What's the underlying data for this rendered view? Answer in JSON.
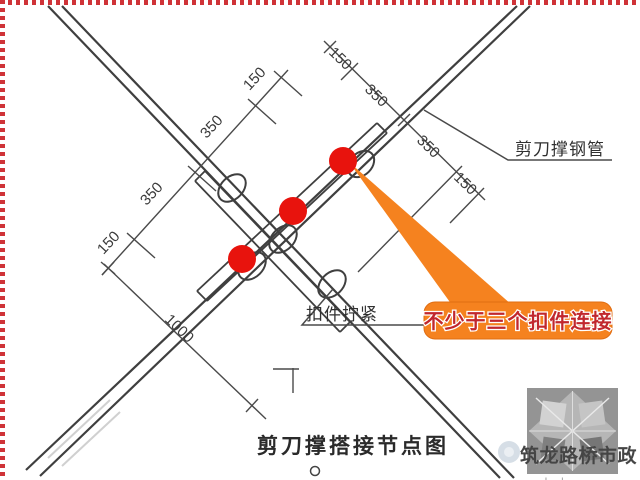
{
  "title_block": {
    "drawing_title": "剪刀撑搭接节点图"
  },
  "labels": {
    "pipe": "剪刀撑钢管",
    "coupler": "扣件拧紧"
  },
  "callout": {
    "text": "不少于三个扣件连接"
  },
  "dims": {
    "left_chain": [
      "150",
      "350",
      "350",
      "150"
    ],
    "right_chain": [
      "150",
      "350",
      "350",
      "150"
    ],
    "lap_length": "1000"
  },
  "watermark": {
    "brand": "筑龙路桥市政",
    "site": "zhulong.com"
  },
  "colors": {
    "marker_red": "#e8130d",
    "callout_orange": "#f5821f",
    "callout_border": "#e06d12",
    "callout_text_red": "#c1272d",
    "line_dark": "#3f3f3f",
    "border_red": "#cf3338",
    "watermark_gray": "#8f8f8f"
  }
}
